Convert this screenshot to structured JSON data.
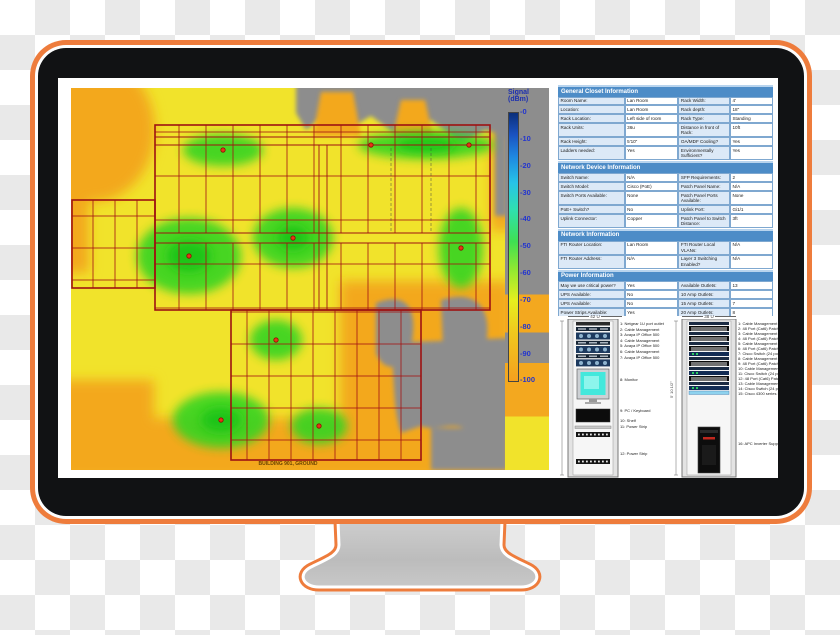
{
  "colors": {
    "accent_orange": "#ee7c3c",
    "table_header_blue": "#4d8cc7",
    "legend_text_blue": "#2335cf",
    "heat_yellow": "#f1e32b",
    "heat_orange": "#f3a81f",
    "heat_green": "#35d420",
    "heat_gray": "#8d8d8d"
  },
  "screen": {
    "floorplan": {
      "caption": "BUILDING 901, GROUND"
    },
    "legend": {
      "title": "Signal",
      "title2": "(dBm)",
      "ticks": [
        "-0",
        "-10",
        "-20",
        "-30",
        "-40",
        "-50",
        "-60",
        "-70",
        "-80",
        "-90",
        "-100"
      ]
    },
    "tables": [
      {
        "header": "General Closet Information",
        "rows": [
          [
            "Room Name:",
            "Lan Room",
            "Rack Width:",
            "4'"
          ],
          [
            "Location:",
            "Lan Room",
            "Rack depth:",
            "18\""
          ],
          [
            "Rack Location:",
            "Left side of room",
            "Rack Type:",
            "Standing"
          ],
          [
            "Rack Units:",
            "36u",
            "Distance in front of Rack:",
            "10ft"
          ],
          [
            "Rack Height:",
            "5'10\"",
            "OA/MDF Cooling?",
            "Yes"
          ],
          [
            "Ladders needed:",
            "Yes",
            "Environmentally Sufficient?",
            "Yes"
          ]
        ]
      },
      {
        "header": "Network Device Information",
        "rows": [
          [
            "Switch Name:",
            "N/A",
            "SFP Requirements:",
            "2"
          ],
          [
            "Switch Model:",
            "Cisco (PoE)",
            "Patch Panel Name:",
            "N/A"
          ],
          [
            "Switch Ports Available:",
            "None",
            "Patch Panel Ports Available:",
            "None"
          ],
          [
            "PoE+ Switch?",
            "No",
            "Uplink Port:",
            "Gi1/1"
          ],
          [
            "Uplink Connector:",
            "Copper",
            "Patch Panel to Switch Distance:",
            "3ft"
          ]
        ]
      },
      {
        "header": "Network Information",
        "rows": [
          [
            "FTI Router Location:",
            "Lan Room",
            "FTI Router Local VLANs:",
            "N/A"
          ],
          [
            "FTI Router Address:",
            "N/A",
            "Layer 3 Switching Enabled?",
            "N/A"
          ]
        ]
      },
      {
        "header": "Power Information",
        "rows": [
          [
            "May we use critical power?",
            "Yes",
            "Available Outlets:",
            "13"
          ],
          [
            "UPS Available:",
            "No",
            "10 Amp Outlets:",
            ""
          ],
          [
            "UPS Available:",
            "No",
            "15 Amp Outlets:",
            "7"
          ],
          [
            "Power Strips Available:",
            "Yes",
            "20 Amp Outlets:",
            "8"
          ],
          [
            "Number of Additional Standalone UPS units required:",
            "1",
            "Number of Additional Rack-Mounted UPS units required:",
            "None"
          ]
        ]
      }
    ],
    "racks": [
      {
        "width_label": "42 U",
        "items": [
          "1: Netgear 1U port outlet",
          "2: Cable Management",
          "3: Avaya IP Office 500",
          "4: Cable Management",
          "5: Avaya IP Office 500",
          "6: Cable Management",
          "7: Avaya IP Office 500",
          "8: Monitor",
          "9: PC / Keyboard",
          "10: Shelf",
          "11: Power Strip",
          "12: Power Strip"
        ]
      },
      {
        "width_label": "38 U",
        "height_label": "5' 10 1/2\"",
        "items": [
          "1: Cable Management",
          "2: 48 Port (Cat6) Patch Panel",
          "3: Cable Management",
          "4: 48 Port (Cat6) Patch Panel",
          "5: Cable Management",
          "6: 48 Port (Cat6) Patch Panel",
          "7: Cisco Switch (24 port 3850)",
          "8: Cable Management",
          "9: 48 Port (Cat6) Patch Panel",
          "10: Cable Management",
          "11: Cisco Switch (24 port 2960)",
          "12: 48 Port (Cat6) Patch Panel",
          "13: Cable Management",
          "14: Cisco Switch (24 port 2960)",
          "15: Cisco 4300 series Router",
          "16: APC Inverter Support"
        ]
      }
    ]
  }
}
